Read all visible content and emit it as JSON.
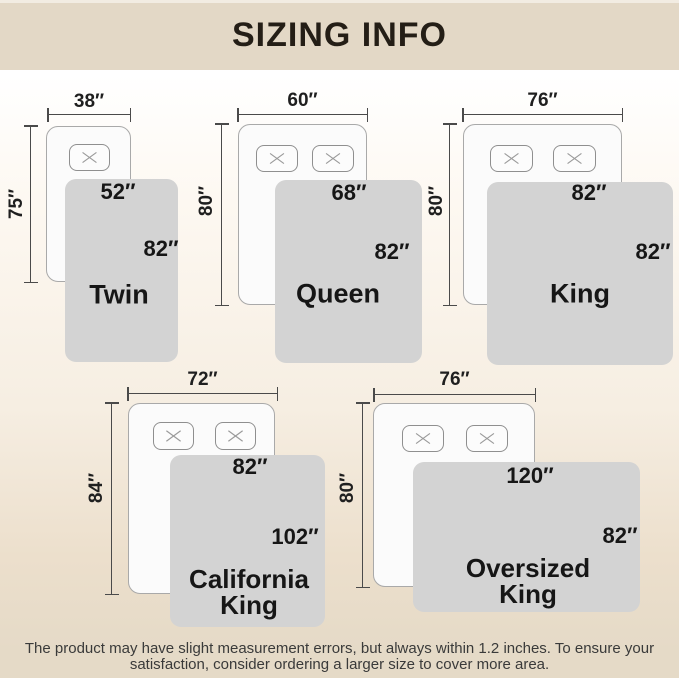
{
  "title": "SIZING INFO",
  "colors": {
    "header_bg": "#e3d8c6",
    "title_text": "#241e16",
    "line": "#4a4a4a",
    "dim_text": "#1f1f1f",
    "bed_fill": "#fbfbfb",
    "bed_border": "#a9a9a9",
    "blanket": "#d3d3d3",
    "label_text": "#161616",
    "footer_text": "#3a3a3a"
  },
  "beds": [
    {
      "name": "Twin",
      "name_lines": [
        "Twin"
      ],
      "bed_width": "38″",
      "bed_length": "75″",
      "blanket_width": "52″",
      "blanket_length": "82″",
      "pillow_count": 1
    },
    {
      "name": "Queen",
      "name_lines": [
        "Queen"
      ],
      "bed_width": "60″",
      "bed_length": "80″",
      "blanket_width": "68″",
      "blanket_length": "82″",
      "pillow_count": 2
    },
    {
      "name": "King",
      "name_lines": [
        "King"
      ],
      "bed_width": "76″",
      "bed_length": "80″",
      "blanket_width": "82″",
      "blanket_length": "82″",
      "pillow_count": 2
    },
    {
      "name": "California King",
      "name_lines": [
        "California",
        "King"
      ],
      "bed_width": "72″",
      "bed_length": "84″",
      "blanket_width": "82″",
      "blanket_length": "102″",
      "pillow_count": 2
    },
    {
      "name": "Oversized King",
      "name_lines": [
        "Oversized",
        "King"
      ],
      "bed_width": "76″",
      "bed_length": "80″",
      "blanket_width": "120″",
      "blanket_length": "82″",
      "pillow_count": 2
    }
  ],
  "footer": {
    "line1": "The product may have slight measurement errors, but always within 1.2 inches. To ensure your",
    "line2": "satisfaction, consider ordering a larger size to cover more area."
  }
}
